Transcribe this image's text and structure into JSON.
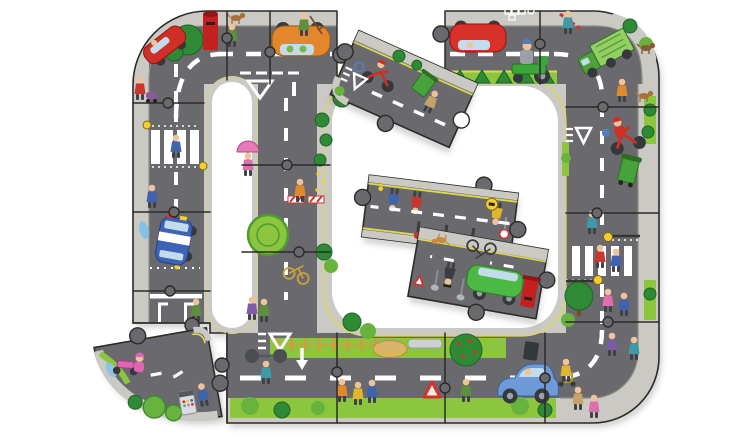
{
  "meta": {
    "alt": "Giant floor jigsaw puzzle of a looping grey city road, mostly assembled, with cartoon cars, bikes and pedestrians printed on it and four loose pieces lying detached",
    "width": 750,
    "height": 440
  },
  "colors": {
    "road": "#6a6a6e",
    "pavement": "#cac9c4",
    "curb": "#8f8e89",
    "grass": "#8cc63f",
    "grassMid": "#67b33e",
    "bushDark": "#2f8a36",
    "hedge": "#3f9c3c",
    "yellowLine": "#ded84e",
    "marking": "#ffffff",
    "seam": "#2d2a27",
    "shadow": "rgba(70,70,70,0.22)",
    "postbox": "#c4201f",
    "carOrange": "#e2872b",
    "carRed": "#d8312a",
    "truckGreen": "#55b43f",
    "truckGreenLight": "#93cf62",
    "mowerGreen": "#3da63b",
    "policeBlue": "#3c63b5",
    "carBlue": "#6f9ad9",
    "carGreen": "#4db945",
    "scooterPink": "#df64b4",
    "bikeRed": "#cf2f27",
    "skin": "#eec39a",
    "hay": "#d9b469",
    "window": "#c3dcec",
    "binGreen": "#46a33c",
    "beacon": "#f2cf2e",
    "figRed": "#c8362e",
    "figBlue": "#3f63ad",
    "figTeal": "#3e9aa8",
    "figGreen": "#5d8f3c",
    "figYellow": "#e0b62c",
    "figPink": "#dd6fae",
    "figPurple": "#7d5ba6",
    "figOrange": "#e28a2b",
    "figKhaki": "#c3a36b",
    "metal": "#9aa2a8"
  },
  "loose_pieces": {
    "top": {
      "label": "road piece with red motorbike, child cyclist and recycling bin",
      "transform": "translate(404,89) rotate(24)"
    },
    "center_a": {
      "label": "road piece with crossing guard, bollards, racer and mechanic",
      "transform": "translate(440,215) rotate(187)"
    },
    "center_b": {
      "label": "road piece with upside-down green car, postbox, policeman and bicycle",
      "transform": "translate(478,273) rotate(190)"
    },
    "corner": {
      "label": "curved corner piece with pink scooter, bushes and sweet machine",
      "transform": "translate(158,382) rotate(-10)"
    }
  }
}
